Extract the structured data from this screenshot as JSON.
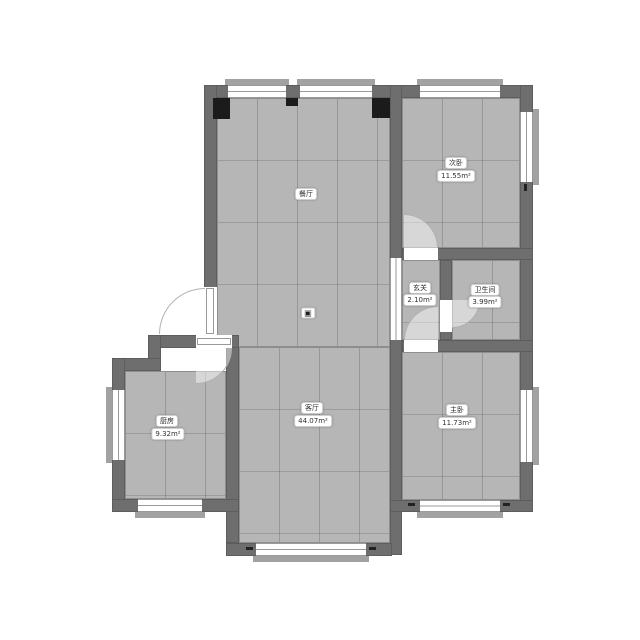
{
  "palette": {
    "background": "#ffffff",
    "wall": "#6e6e6e",
    "floor": "#b6b6b6",
    "tile_line": "#8e8e8e",
    "pillar": "#1b1b1b",
    "window_line": "#9a9a9a",
    "sill": "#a2a2a2",
    "door_arc_line": "#b0b0b0",
    "label_background": "#ffffff",
    "label_text": "#2b2b2b"
  },
  "rooms": [
    {
      "id": "dining",
      "name": "餐厅",
      "area": ""
    },
    {
      "id": "living",
      "name": "客厅",
      "area": "44.07m²"
    },
    {
      "id": "kitchen",
      "name": "厨房",
      "area": "9.32m²"
    },
    {
      "id": "hallway",
      "name": "玄关",
      "area": "2.10m²"
    },
    {
      "id": "bathroom",
      "name": "卫生间",
      "area": "3.99m²"
    },
    {
      "id": "bedroom2",
      "name": "次卧",
      "area": "11.55m²"
    },
    {
      "id": "master",
      "name": "主卧",
      "area": "11.73m²"
    }
  ],
  "marker": {
    "glyph": "▣"
  }
}
